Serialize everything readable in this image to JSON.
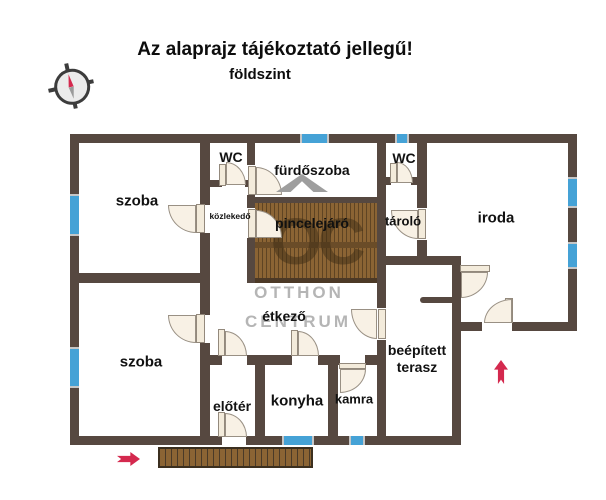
{
  "title": "Az alaprajz tájékoztató jellegű!",
  "subtitle": "földszint",
  "rooms": {
    "szoba_top": "szoba",
    "wc_left": "WC",
    "furdoszoba": "fürdőszoba",
    "wc_right": "WC",
    "kozlekedo": "közlekedő",
    "pincelejaro": "pincelejáró",
    "tarolo": "tároló",
    "iroda": "iroda",
    "etkezo": "étkező",
    "szoba_bottom": "szoba",
    "terasz_line1": "beépített",
    "terasz_line2": "terasz",
    "eloter": "előtér",
    "konyha": "konyha",
    "kamra": "kamra"
  },
  "watermark": {
    "logo": "OC",
    "line1": "OTTHON",
    "line2": "CENTRUM"
  },
  "icons": {
    "compass": "compass-rose-icon",
    "entrance_arrow": "red-arrow-right-icon",
    "terrace_arrow": "red-arrow-up-icon",
    "logo_roof": "gray-chevron-icon"
  },
  "colors": {
    "wall": "#564840",
    "window_blue": "#45a2d6",
    "wood_brown": "#8b6434",
    "accent_red": "#d4294e",
    "watermark_gray": "#b5b5b5",
    "door_fill": "#f8f1e5"
  }
}
